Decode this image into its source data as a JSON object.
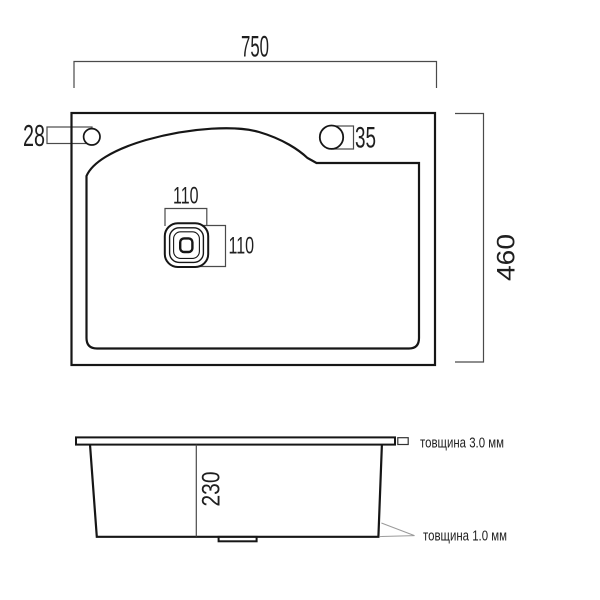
{
  "colors": {
    "background": "#ffffff",
    "outline": "#161616",
    "dimension_lines": "#4a4a4a",
    "leader_lines": "#9a9a9a",
    "text": "#1f1f1f"
  },
  "top_view": {
    "width_dim": "750",
    "height_dim": "460",
    "left_faucet_hole_dim": "28",
    "right_faucet_hole_dim": "35",
    "drain_width_dim": "110",
    "drain_height_dim": "110"
  },
  "side_view": {
    "depth_dim": "230",
    "rim_thickness_note": "товщина 3.0 мм",
    "wall_thickness_note": "товщина 1.0 мм"
  }
}
